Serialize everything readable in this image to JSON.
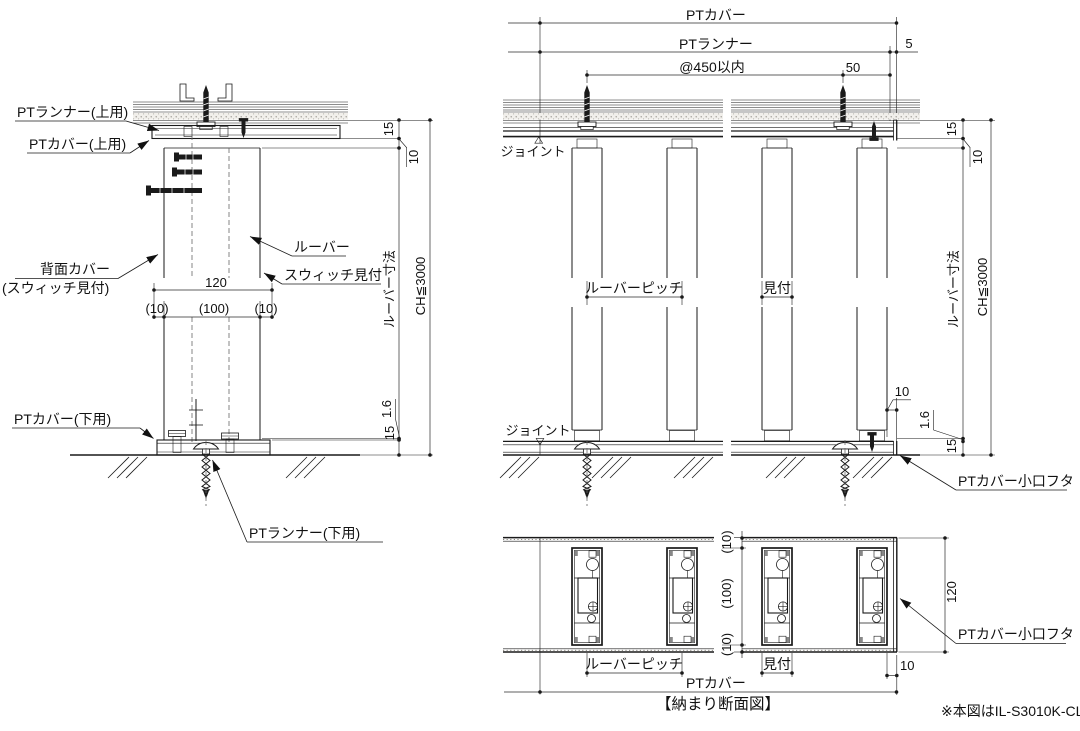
{
  "figure": {
    "title": "【納まり断面図】",
    "note": "※本図はIL-S3010K-CL"
  },
  "left_view": {
    "labels": {
      "pt_runner_top": "PTランナー(上用)",
      "pt_cover_top": "PTカバー(上用)",
      "back_cover": "背面カバー",
      "back_cover_sub": "(スウィッチ見付)",
      "louver": "ルーバー",
      "switch_face": "スウィッチ見付",
      "pt_cover_bottom": "PTカバー(下用)",
      "pt_runner_bottom": "PTランナー(下用)"
    },
    "dims": {
      "width_total": "120",
      "width_left": "(10)",
      "width_center": "(100)",
      "width_right": "(10)",
      "top_clearance": "15",
      "cover_gap": "10",
      "louver_length": "ルーバー寸法",
      "ceiling_height": "CH≦3000",
      "bottom_gap": "1.6",
      "bottom_clearance": "15"
    }
  },
  "elevation": {
    "dims": {
      "pt_cover_width": "PTカバー",
      "pt_runner_width": "PTランナー",
      "end_offset": "5",
      "screw_pitch": "@450以内",
      "screw_end_offset": "50",
      "louver_pitch": "ルーバーピッチ",
      "louver_face": "見付",
      "end_clearance": "10",
      "top_clearance": "15",
      "cover_gap": "10",
      "louver_length": "ルーバー寸法",
      "ceiling_height": "CH≦3000",
      "bottom_gap": "1.6",
      "bottom_clearance": "15"
    },
    "labels": {
      "joint_top": "ジョイント",
      "joint_bottom": "ジョイント",
      "cover_end_cap": "PTカバー小口フタ"
    }
  },
  "plan_view": {
    "dims": {
      "depth_top": "(10)",
      "depth_center": "(100)",
      "depth_bottom": "(10)",
      "depth_total": "120",
      "louver_pitch": "ルーバーピッチ",
      "louver_face": "見付",
      "end_clearance": "10",
      "pt_cover_width": "PTカバー"
    },
    "labels": {
      "cover_end_cap": "PTカバー小口フタ"
    }
  }
}
